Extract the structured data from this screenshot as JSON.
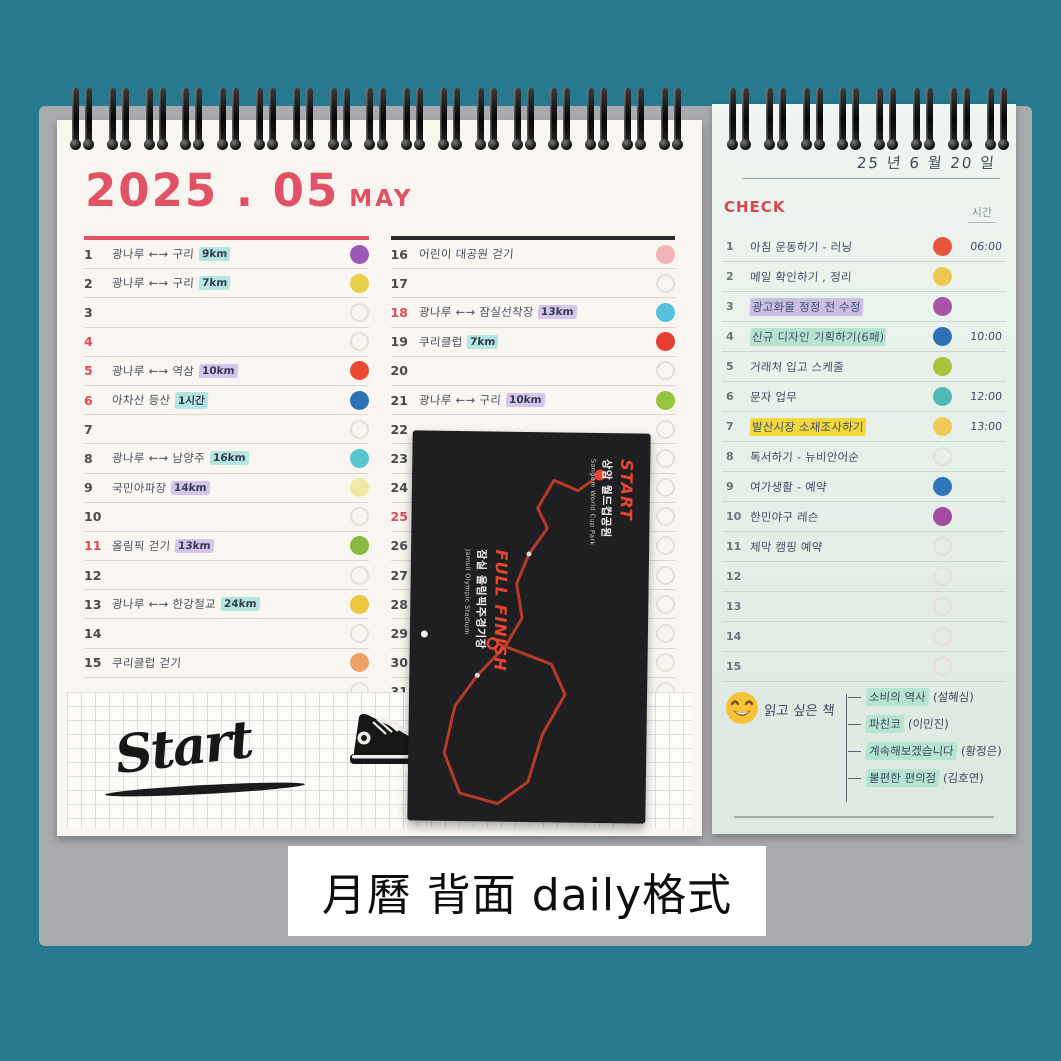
{
  "photo_caption": {
    "text": "月曆 背面 daily格式"
  },
  "monthly_calendar": {
    "title": "2025 . 05",
    "month_name": "MAY",
    "left_rows": [
      {
        "day": "1",
        "red": false,
        "text": "광나루 ←→ 구리",
        "badge": "9km",
        "badge_style": "cyan",
        "dot": "#9b59b6"
      },
      {
        "day": "2",
        "red": false,
        "text": "광나루 ←→ 구리",
        "badge": "7km",
        "badge_style": "cyan",
        "dot": "#e7d04c"
      },
      {
        "day": "3",
        "red": false,
        "text": "",
        "badge": "",
        "badge_style": "",
        "dot": ""
      },
      {
        "day": "4",
        "red": true,
        "text": "",
        "badge": "",
        "badge_style": "",
        "dot": ""
      },
      {
        "day": "5",
        "red": true,
        "text": "광나루 ←→ 역삼",
        "badge": "10km",
        "badge_style": "purple",
        "dot": "#ea4a2f"
      },
      {
        "day": "6",
        "red": true,
        "text": "아차산 등산",
        "badge": "1시간",
        "badge_style": "cyan",
        "dot": "#2e73b1"
      },
      {
        "day": "7",
        "red": false,
        "text": "",
        "badge": "",
        "badge_style": "",
        "dot": ""
      },
      {
        "day": "8",
        "red": false,
        "text": "광나루 ←→ 남양주",
        "badge": "16km",
        "badge_style": "cyan",
        "dot": "#58c6cf"
      },
      {
        "day": "9",
        "red": false,
        "text": "국민아파장",
        "badge": "14km",
        "badge_style": "purple",
        "dot": "#efe9a8"
      },
      {
        "day": "10",
        "red": false,
        "text": "",
        "badge": "",
        "badge_style": "",
        "dot": ""
      },
      {
        "day": "11",
        "red": true,
        "text": "올림픽 걷기",
        "badge": "13km",
        "badge_style": "purple",
        "dot": "#87ba3f"
      },
      {
        "day": "12",
        "red": false,
        "text": "",
        "badge": "",
        "badge_style": "",
        "dot": ""
      },
      {
        "day": "13",
        "red": false,
        "text": "광나루 ←→ 한강철교",
        "badge": "24km",
        "badge_style": "cyan",
        "dot": "#ecc63f"
      },
      {
        "day": "14",
        "red": false,
        "text": "",
        "badge": "",
        "badge_style": "",
        "dot": ""
      },
      {
        "day": "15",
        "red": false,
        "text": "쿠리클럽 걷기",
        "badge": "",
        "badge_style": "",
        "dot": "#eca266"
      },
      {
        "day": "",
        "red": false,
        "text": "",
        "badge": "",
        "badge_style": "",
        "dot": ""
      }
    ],
    "right_rows": [
      {
        "day": "16",
        "red": false,
        "text": "어린이 대공원 걷기",
        "badge": "",
        "badge_style": "",
        "dot": "#f2b2b6"
      },
      {
        "day": "17",
        "red": false,
        "text": "",
        "badge": "",
        "badge_style": "",
        "dot": ""
      },
      {
        "day": "18",
        "red": true,
        "text": "광나루 ←→ 잠실선착장",
        "badge": "13km",
        "badge_style": "purple",
        "dot": "#55c1dc"
      },
      {
        "day": "19",
        "red": false,
        "text": "쿠리클럽",
        "badge": "7km",
        "badge_style": "cyan",
        "dot": "#e73f32"
      },
      {
        "day": "20",
        "red": false,
        "text": "",
        "badge": "",
        "badge_style": "",
        "dot": ""
      },
      {
        "day": "21",
        "red": false,
        "text": "광나루 ←→ 구리",
        "badge": "10km",
        "badge_style": "purple",
        "dot": "#96c43d"
      },
      {
        "day": "22",
        "red": false,
        "text": "",
        "badge": "",
        "badge_style": "",
        "dot": ""
      },
      {
        "day": "23",
        "red": false,
        "text": "",
        "badge": "",
        "badge_style": "",
        "dot": ""
      },
      {
        "day": "24",
        "red": false,
        "text": "",
        "badge": "",
        "badge_style": "",
        "dot": ""
      },
      {
        "day": "25",
        "red": true,
        "text": "",
        "badge": "",
        "badge_style": "",
        "dot": ""
      },
      {
        "day": "26",
        "red": false,
        "text": "",
        "badge": "",
        "badge_style": "",
        "dot": ""
      },
      {
        "day": "27",
        "red": false,
        "text": "",
        "badge": "",
        "badge_style": "",
        "dot": ""
      },
      {
        "day": "28",
        "red": false,
        "text": "",
        "badge": "",
        "badge_style": "",
        "dot": ""
      },
      {
        "day": "29",
        "red": false,
        "text": "",
        "badge": "",
        "badge_style": "",
        "dot": ""
      },
      {
        "day": "30",
        "red": false,
        "text": "",
        "badge": "",
        "badge_style": "",
        "dot": ""
      },
      {
        "day": "31",
        "red": false,
        "text": "",
        "badge": "",
        "badge_style": "",
        "dot": ""
      }
    ]
  },
  "doodle": {
    "start_text": "Start"
  },
  "race_card": {
    "start_label": "START",
    "start_place_ko": "상암 월드컵공원",
    "start_place_en": "Sangam World Cup Park",
    "finish_label": "FULL FINISH",
    "finish_place_ko": "잠실 올림픽주경기장",
    "finish_place_en": "Jamsil Olympic Stadium"
  },
  "daily_page": {
    "date_text": "25 년 6 월 20 일",
    "check_label": "CHECK",
    "time_label": "시간",
    "rows": [
      {
        "num": "1",
        "text": "아침 운동하기 - 러닝",
        "hl": "",
        "dot": "#e8543a",
        "time": "06:00"
      },
      {
        "num": "2",
        "text": "메일 확인하기 , 정리",
        "hl": "",
        "dot": "#edc84e",
        "time": ""
      },
      {
        "num": "3",
        "text": "광고화물 정정 전 수정",
        "hl": "purple",
        "dot": "#a855a8",
        "time": ""
      },
      {
        "num": "4",
        "text": "신규 디자인 기획하기(6페)",
        "hl": "mint",
        "dot": "#2f6fb4",
        "time": "10:00"
      },
      {
        "num": "5",
        "text": "거래처 입고 스케줄",
        "hl": "",
        "dot": "#a8c23f",
        "time": ""
      },
      {
        "num": "6",
        "text": "문자 업무",
        "hl": "",
        "dot": "#4fb9b4",
        "time": "12:00"
      },
      {
        "num": "7",
        "text": "발산시장 소재조사하기",
        "hl": "yellow",
        "dot": "#eecb59",
        "time": "13:00"
      },
      {
        "num": "8",
        "text": "독서하기 - 뉴비안어순",
        "hl": "",
        "dot": "",
        "time": ""
      },
      {
        "num": "9",
        "text": "여가생활 - 예약",
        "hl": "",
        "dot": "#2f76ba",
        "time": ""
      },
      {
        "num": "10",
        "text": "한민야구 레슨",
        "hl": "",
        "dot": "#a34ba0",
        "time": ""
      },
      {
        "num": "11",
        "text": "제막 캠핑 예약",
        "hl": "",
        "dot": "",
        "time": ""
      },
      {
        "num": "12",
        "text": "",
        "hl": "",
        "dot": "",
        "time": ""
      },
      {
        "num": "13",
        "text": "",
        "hl": "",
        "dot": "",
        "time": ""
      },
      {
        "num": "14",
        "text": "",
        "hl": "",
        "dot": "",
        "time": ""
      },
      {
        "num": "15",
        "text": "",
        "hl": "",
        "dot": "",
        "time": ""
      }
    ],
    "reading_list": {
      "title": "읽고 싶은 책",
      "books": [
        {
          "title": "소비의 역사",
          "author": "(설혜심)"
        },
        {
          "title": "파친코",
          "author": "(이민진)"
        },
        {
          "title": "계속해보겠습니다",
          "author": "(황정은)"
        },
        {
          "title": "불편한 편의점",
          "author": "(김호연)"
        }
      ]
    }
  }
}
